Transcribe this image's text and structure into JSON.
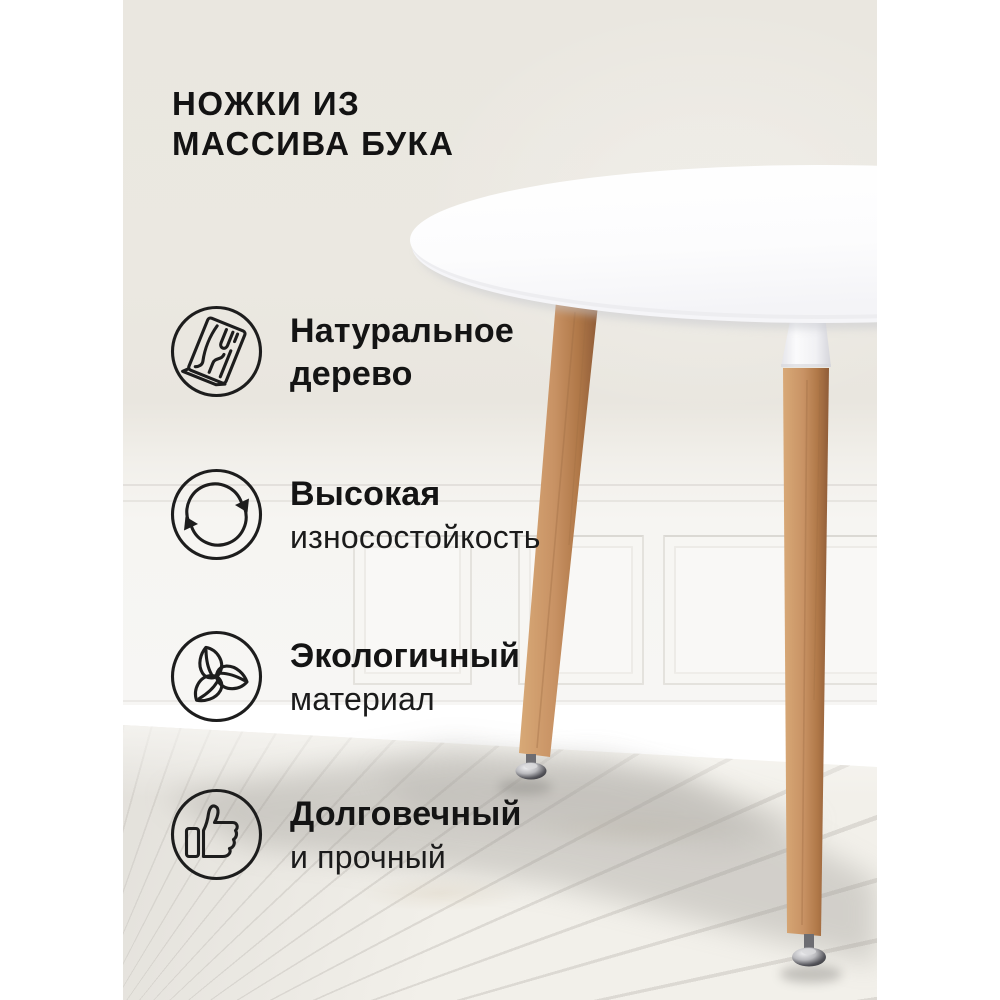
{
  "product_card": {
    "heading": {
      "line1": "НОЖКИ ИЗ",
      "line2": "МАССИВА БУКА"
    },
    "features": [
      {
        "icon": "wood-plank-icon",
        "title": "Натуральное",
        "subtitle": "дерево"
      },
      {
        "icon": "cycle-arrows-icon",
        "title": "Высокая",
        "subtitle": "износостойкость"
      },
      {
        "icon": "eco-leaves-icon",
        "title": "Экологичный",
        "subtitle": "материал"
      },
      {
        "icon": "thumbs-up-icon",
        "title": "Долговечный",
        "subtitle": "и прочный"
      }
    ],
    "photo_alt": "Round white dining table with solid beech wood legs and chrome adjustable feet, standing on a whitewashed plank floor against a wall with white wainscoting panels",
    "colors": {
      "canvas": "#FFFFFF",
      "wall_beige": "#EBE8E1",
      "wainscot_white": "#F7F6F4",
      "floor": "#F1EFE9",
      "tabletop": "#FDFDFE",
      "leg_wood": "#C08A5C",
      "chrome_foot": "#55555B",
      "text": "#141414"
    }
  }
}
